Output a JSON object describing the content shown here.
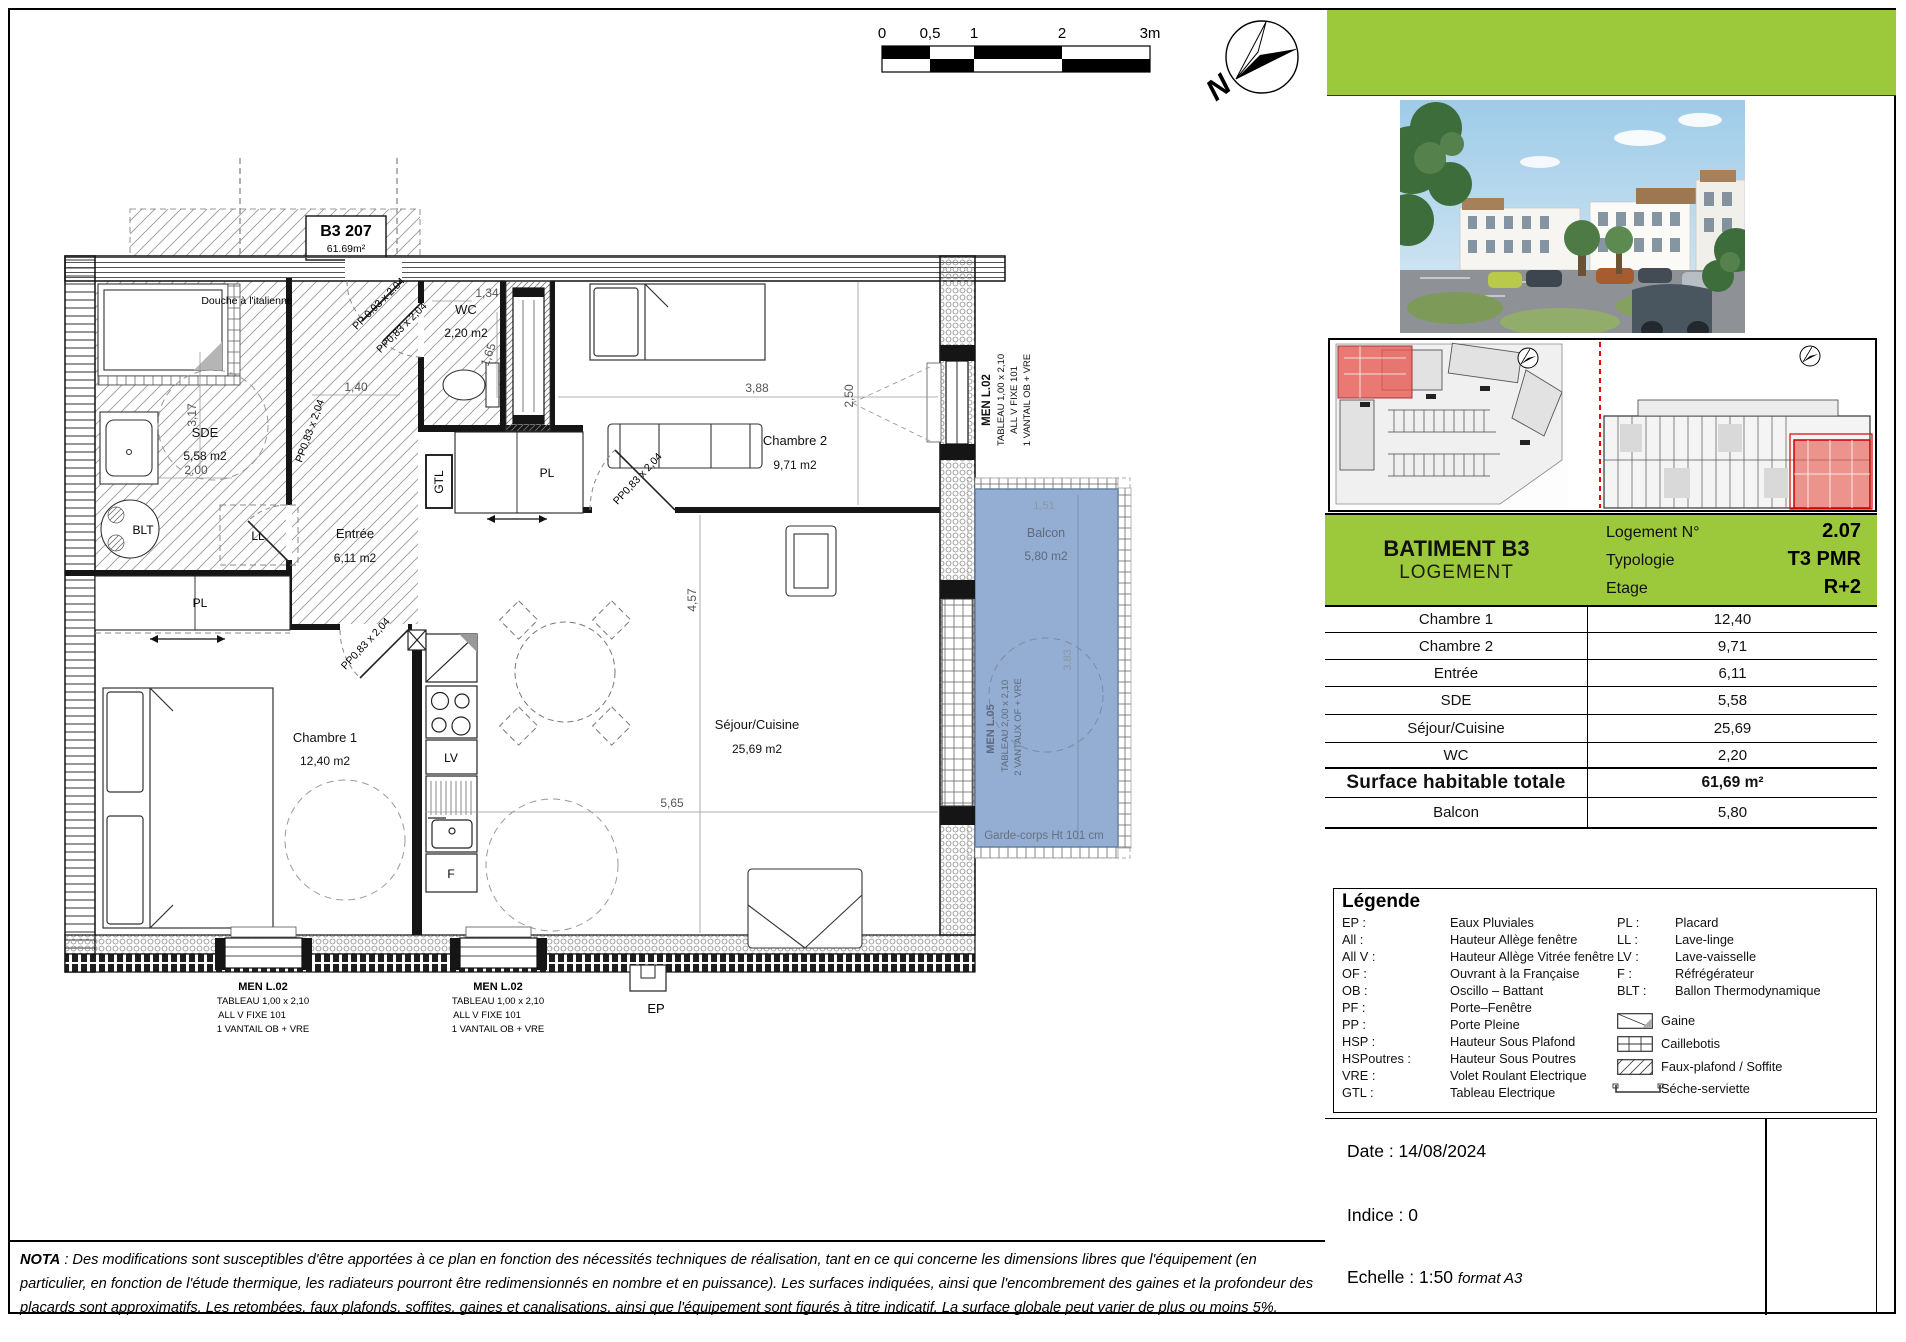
{
  "header": {
    "scale_ticks": [
      "0",
      "0,5",
      "1",
      "2",
      "3m"
    ],
    "north": "N"
  },
  "unit_tag": {
    "code": "B3 207",
    "area": "61.69m²"
  },
  "plan": {
    "rooms": {
      "sde": {
        "name": "SDE",
        "area": "5,58 m2"
      },
      "wc": {
        "name": "WC",
        "area": "2,20 m2"
      },
      "entree": {
        "name": "Entrée",
        "area": "6,11 m2"
      },
      "chambre1": {
        "name": "Chambre 1",
        "area": "12,40 m2"
      },
      "chambre2": {
        "name": "Chambre 2",
        "area": "9,71 m2"
      },
      "sejour": {
        "name": "Séjour/Cuisine",
        "area": "25,69 m2"
      },
      "balcon": {
        "name": "Balcon",
        "area": "5,80 m2"
      }
    },
    "features": {
      "douche": "Douche à l'italienne",
      "garde_corps": "Garde-corps Ht 101 cm",
      "blt": "BLT",
      "ll": "LL",
      "lv": "LV",
      "f": "F",
      "gtl": "GTL",
      "pl": "PL",
      "ep": "EP"
    },
    "doors": {
      "entrance": "PP  0.93 x 2.04",
      "standard": "PP0,83 x 2,04"
    },
    "dims": {
      "d317": "3,17",
      "d200": "2,00",
      "d140": "1,40",
      "d134": "1,34",
      "d165": "1,65",
      "d388": "3,88",
      "d250": "2,50",
      "d565": "5,65",
      "d457": "4,57",
      "d151": "1,51",
      "d383": "3,83"
    },
    "windows": {
      "l02": {
        "title": "MEN L.02",
        "line1": "TABLEAU  1,00 x 2,10",
        "line2": "ALL V FIXE  101",
        "line3": "1 VANTAIL  OB + VRE"
      },
      "l05": {
        "title": "MEN L.05",
        "line1": "TABLEAU  2,00 x 2,10",
        "line2": "2 VANTAUX OF  + VRE"
      }
    }
  },
  "panel": {
    "building": "BATIMENT B3",
    "building_type": "LOGEMENT",
    "info": [
      {
        "label": "Logement N°",
        "value": "2.07"
      },
      {
        "label": "Typologie",
        "value": "T3 PMR"
      },
      {
        "label": "Etage",
        "value": "R+2"
      }
    ],
    "surfaces": [
      {
        "label": "Chambre 1",
        "value": "12,40"
      },
      {
        "label": "Chambre 2",
        "value": "9,71"
      },
      {
        "label": "Entrée",
        "value": "6,11"
      },
      {
        "label": "SDE",
        "value": "5,58"
      },
      {
        "label": "Séjour/Cuisine",
        "value": "25,69"
      },
      {
        "label": "WC",
        "value": "2,20"
      },
      {
        "label": "Surface habitable totale",
        "value": "61,69 m²"
      },
      {
        "label": "Balcon",
        "value": "5,80"
      }
    ],
    "legend": {
      "title": "Légende",
      "left": [
        {
          "abbr": "EP :",
          "desc": "Eaux Pluviales"
        },
        {
          "abbr": "All :",
          "desc": "Hauteur Allège fenêtre"
        },
        {
          "abbr": "All V :",
          "desc": "Hauteur Allège Vitrée fenêtre"
        },
        {
          "abbr": "OF :",
          "desc": "Ouvrant à la Française"
        },
        {
          "abbr": "OB :",
          "desc": "Oscillo – Battant"
        },
        {
          "abbr": "PF :",
          "desc": "Porte–Fenêtre"
        },
        {
          "abbr": "PP :",
          "desc": "Porte Pleine"
        },
        {
          "abbr": "HSP :",
          "desc": "Hauteur Sous Plafond"
        },
        {
          "abbr": "HSPoutres :",
          "desc": "Hauteur Sous Poutres"
        },
        {
          "abbr": "VRE :",
          "desc": "Volet Roulant Electrique"
        },
        {
          "abbr": "GTL :",
          "desc": "Tableau Electrique"
        }
      ],
      "right": [
        {
          "abbr": "PL :",
          "desc": "Placard"
        },
        {
          "abbr": "LL :",
          "desc": "Lave-linge"
        },
        {
          "abbr": "LV :",
          "desc": "Lave-vaisselle"
        },
        {
          "abbr": "F :",
          "desc": "Réfrégérateur"
        },
        {
          "abbr": "BLT :",
          "desc": "Ballon Thermodynamique"
        }
      ],
      "symbols": [
        {
          "icon": "gaine",
          "desc": "Gaine"
        },
        {
          "icon": "caillebotis",
          "desc": "Caillebotis"
        },
        {
          "icon": "faux-plafond",
          "desc": "Faux-plafond / Soffite"
        },
        {
          "icon": "seche-serviette",
          "desc": "Séche-serviette"
        }
      ]
    },
    "cartouche": {
      "date": "Date : 14/08/2024",
      "indice": "Indice : 0",
      "echelle": "Echelle : 1:50",
      "echelle_format": "format A3"
    }
  },
  "nota": {
    "label": "NOTA",
    "text": " : Des modifications sont susceptibles d'être apportées à ce plan en fonction des nécessités techniques de réalisation, tant en ce qui concerne les dimensions libres que l'équipement (en particulier, en fonction de l'étude thermique, les radiateurs pourront être redimensionnés en nombre et en puissance). Les surfaces indiquées, ainsi que l'encombrement des gaines et la profondeur des placards sont approximatifs. Les retombées, faux plafonds, soffites, gaines et canalisations, ainsi que l'équipement sont figurés à titre indicatif. La surface globale peut varier de plus ou moins 5%."
  },
  "colors": {
    "green": "#9cc93c",
    "balcony_blue": "#8ba6cf",
    "highlight_red": "#e8574f"
  }
}
